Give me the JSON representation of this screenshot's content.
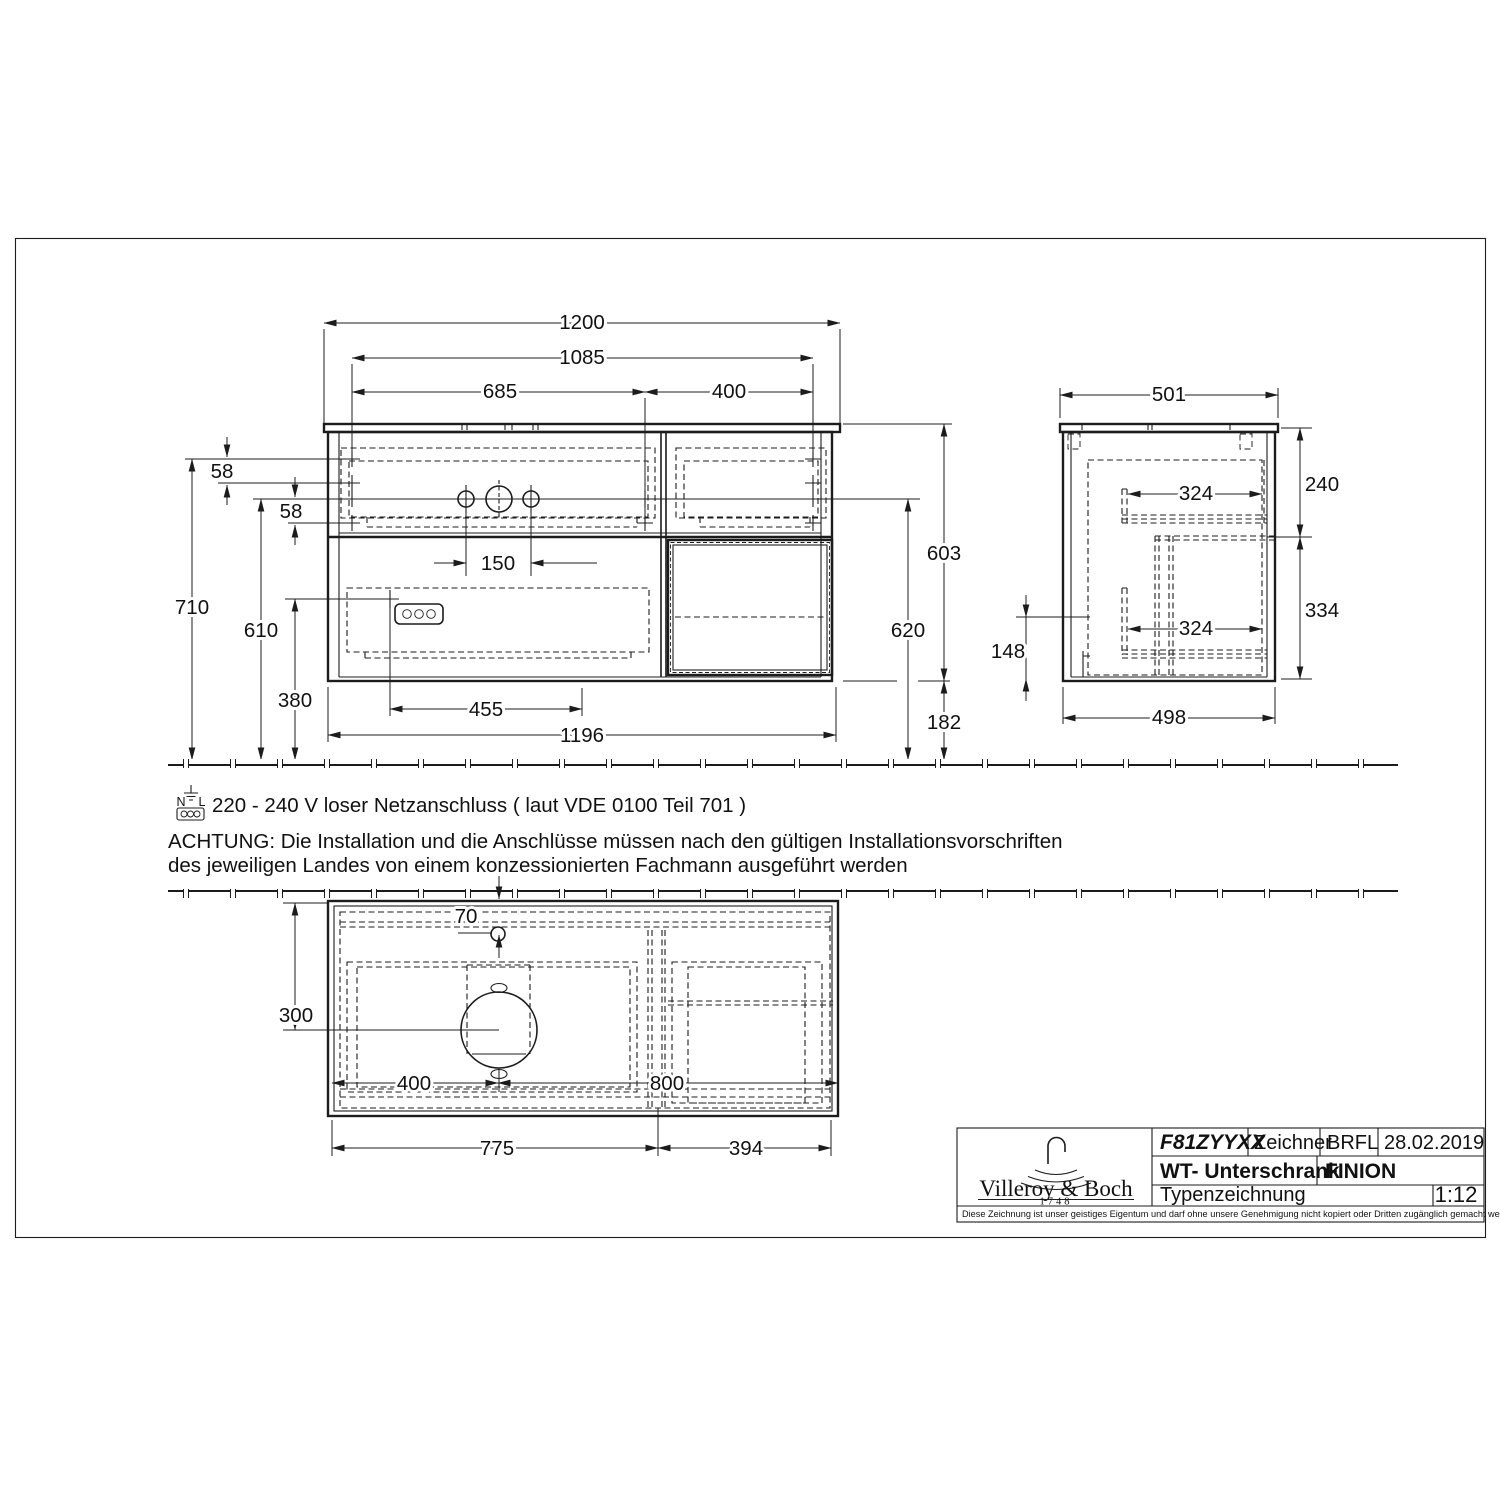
{
  "front": {
    "w1200": "1200",
    "w1085": "1085",
    "w685": "685",
    "w400": "400",
    "g58a": "58",
    "g58b": "58",
    "h710": "710",
    "h610": "610",
    "h380": "380",
    "g150": "150",
    "g455": "455",
    "w1196": "1196",
    "h603": "603",
    "h620": "620",
    "h182": "182"
  },
  "side": {
    "w501": "501",
    "d324a": "324",
    "d324b": "324",
    "h240": "240",
    "h334": "334",
    "h148": "148",
    "w498": "498"
  },
  "top": {
    "g70": "70",
    "g300": "300",
    "g400": "400",
    "g800": "800",
    "w775": "775",
    "w394": "394"
  },
  "notes": {
    "sym_n": "N",
    "sym_l": "L",
    "power": "220 - 240 V loser Netzanschluss ( laut VDE 0100 Teil 701 )",
    "warn1": "ACHTUNG: Die Installation und die Anschlüsse müssen nach den gültigen Installationsvorschriften",
    "warn2": "des jeweiligen Landes von einem konzessionierten Fachmann ausgeführt werden"
  },
  "title": {
    "brand": "Villeroy & Boch",
    "year": "1748",
    "code": "F81ZYYXX",
    "zeichner_label": "Zeichner",
    "zeichner_value": "BRFL",
    "date": "28.02.2019",
    "product": "WT- Unterschrank",
    "series": "FINION",
    "doctype": "Typenzeichnung",
    "scale": "1:12",
    "disclaimer": "Diese Zeichnung ist unser geistiges Eigentum und darf ohne unsere Genehmigung nicht kopiert oder Dritten zugänglich gemacht werden."
  }
}
